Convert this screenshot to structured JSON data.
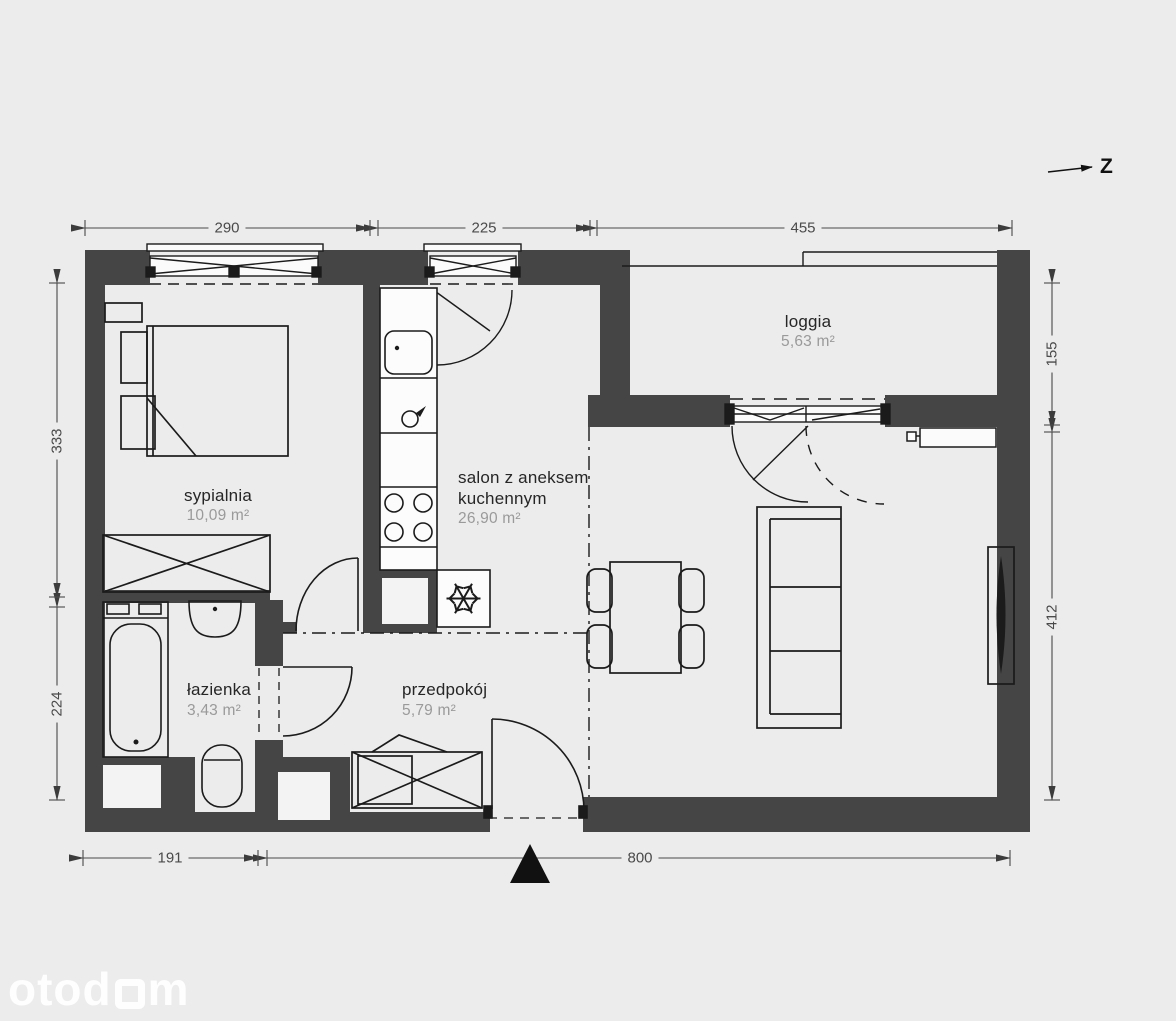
{
  "meta": {
    "background_color": "#ececec",
    "wall_color": "#454545",
    "line_color": "#1b1b1b",
    "dimension_color": "#4a4a4a",
    "area_text_color": "#9a9a9a",
    "watermark_color": "#ffffff"
  },
  "north": {
    "label": "Z"
  },
  "rooms": [
    {
      "id": "sypialnia",
      "name": "sypialnia",
      "area": "10,09 m²"
    },
    {
      "id": "salon",
      "name_lines": [
        "salon z aneksem",
        "kuchennym"
      ],
      "area": "26,90 m²"
    },
    {
      "id": "lazienka",
      "name": "łazienka",
      "area": "3,43 m²"
    },
    {
      "id": "przedpokoj",
      "name": "przedpokój",
      "area": "5,79 m²"
    },
    {
      "id": "loggia",
      "name": "loggia",
      "area": "5,63 m²"
    }
  ],
  "dimensions": {
    "top": [
      "290",
      "225",
      "455"
    ],
    "left": [
      "333",
      "224"
    ],
    "right": [
      "155",
      "412"
    ],
    "bottom": [
      "191",
      "800"
    ]
  },
  "watermark": {
    "part1": "otod",
    "part2": "m"
  }
}
